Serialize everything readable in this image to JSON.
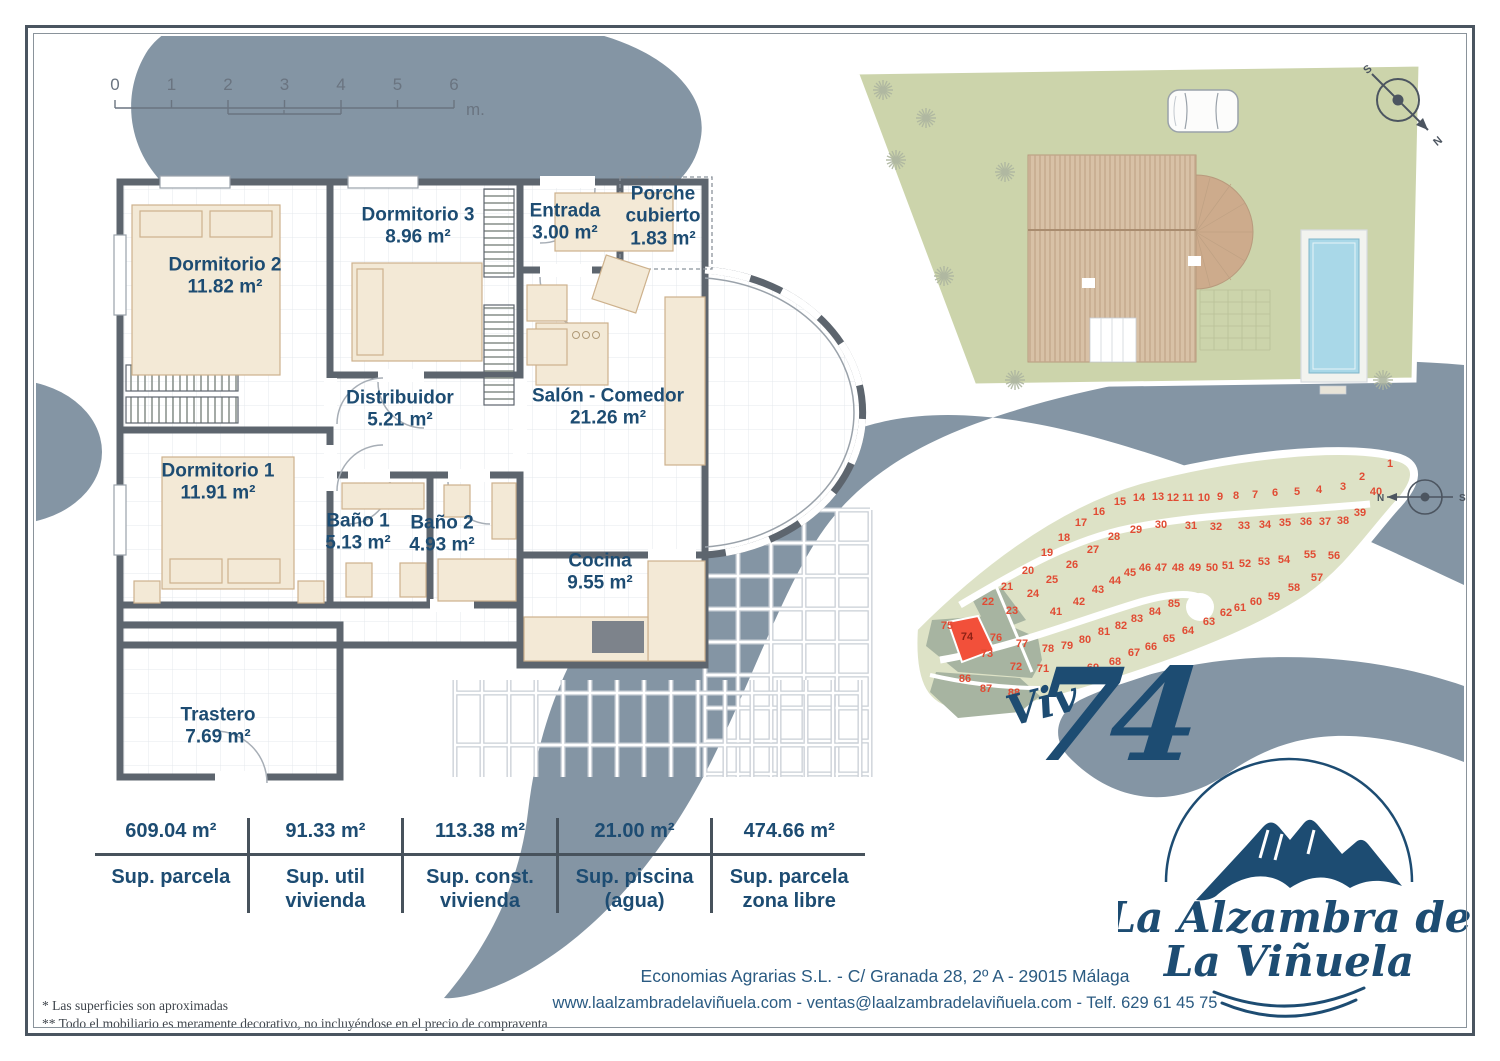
{
  "colors": {
    "navy": "#1d4c72",
    "wave_blue_gray": "#8495a4",
    "wall_gray": "#5d656e",
    "furniture_beige": "#f3e9d6",
    "plot_green": "#dde2c6",
    "plot_sold_olive": "#a7b4a1",
    "plot_highlight_red": "#f2503a",
    "plot_number_red": "#e14b33",
    "site_grass": "#ccd4ab",
    "roof_tan": "#d8c1a6",
    "pool_blue": "#a9d8e8",
    "frame_slate": "#4a5560"
  },
  "scale_bar": {
    "ticks": [
      "0",
      "1",
      "2",
      "3",
      "4",
      "5",
      "6"
    ],
    "unit": "m."
  },
  "floor_plan": {
    "rooms": [
      {
        "id": "dormitorio-2",
        "name": "Dormitorio 2",
        "area": "11.82 m²",
        "x": 125,
        "y": 112,
        "wrap": false
      },
      {
        "id": "dormitorio-3",
        "name": "Dormitorio 3",
        "area": "8.96 m²",
        "x": 318,
        "y": 62,
        "wrap": false
      },
      {
        "id": "entrada",
        "name": "Entrada",
        "area": "3.00 m²",
        "x": 465,
        "y": 58,
        "wrap": false
      },
      {
        "id": "porche-cubierto",
        "name": "Porche cubierto",
        "area": "1.83 m²",
        "x": 563,
        "y": 52,
        "wrap": true
      },
      {
        "id": "distribuidor",
        "name": "Distribuidor",
        "area": "5.21 m²",
        "x": 300,
        "y": 245,
        "wrap": false
      },
      {
        "id": "salon-comedor",
        "name": "Salón - Comedor",
        "area": "21.26 m²",
        "x": 508,
        "y": 243,
        "wrap": false
      },
      {
        "id": "dormitorio-1",
        "name": "Dormitorio 1",
        "area": "11.91 m²",
        "x": 118,
        "y": 318,
        "wrap": false
      },
      {
        "id": "bano-1",
        "name": "Baño 1",
        "area": "5.13 m²",
        "x": 258,
        "y": 368,
        "wrap": false
      },
      {
        "id": "bano-2",
        "name": "Baño 2",
        "area": "4.93 m²",
        "x": 342,
        "y": 370,
        "wrap": false
      },
      {
        "id": "cocina",
        "name": "Cocina",
        "area": "9.55 m²",
        "x": 500,
        "y": 408,
        "wrap": false
      },
      {
        "id": "trastero",
        "name": "Trastero",
        "area": "7.69 m²",
        "x": 118,
        "y": 562,
        "wrap": false
      }
    ]
  },
  "site_plan": {
    "compass": {
      "n": "N",
      "s": "S"
    }
  },
  "plot_map": {
    "highlighted_plot": 74,
    "sold_plots": [
      22,
      23,
      72,
      73,
      75,
      76,
      77,
      86,
      87,
      88
    ],
    "compass": {
      "n": "N",
      "s": "S"
    },
    "plots": [
      {
        "n": 1,
        "x": 490,
        "y": 47
      },
      {
        "n": 2,
        "x": 462,
        "y": 60
      },
      {
        "n": 3,
        "x": 443,
        "y": 70
      },
      {
        "n": 4,
        "x": 419,
        "y": 73
      },
      {
        "n": 5,
        "x": 397,
        "y": 75
      },
      {
        "n": 6,
        "x": 375,
        "y": 76
      },
      {
        "n": 7,
        "x": 355,
        "y": 78
      },
      {
        "n": 8,
        "x": 336,
        "y": 79
      },
      {
        "n": 9,
        "x": 320,
        "y": 80
      },
      {
        "n": 10,
        "x": 304,
        "y": 81
      },
      {
        "n": 11,
        "x": 288,
        "y": 81
      },
      {
        "n": 12,
        "x": 273,
        "y": 81
      },
      {
        "n": 13,
        "x": 258,
        "y": 80
      },
      {
        "n": 14,
        "x": 239,
        "y": 81
      },
      {
        "n": 15,
        "x": 220,
        "y": 85
      },
      {
        "n": 16,
        "x": 199,
        "y": 95
      },
      {
        "n": 17,
        "x": 181,
        "y": 106
      },
      {
        "n": 18,
        "x": 164,
        "y": 121
      },
      {
        "n": 19,
        "x": 147,
        "y": 136
      },
      {
        "n": 20,
        "x": 128,
        "y": 154
      },
      {
        "n": 21,
        "x": 107,
        "y": 170
      },
      {
        "n": 22,
        "x": 88,
        "y": 185
      },
      {
        "n": 23,
        "x": 112,
        "y": 194
      },
      {
        "n": 24,
        "x": 133,
        "y": 177
      },
      {
        "n": 25,
        "x": 152,
        "y": 163
      },
      {
        "n": 26,
        "x": 172,
        "y": 148
      },
      {
        "n": 27,
        "x": 193,
        "y": 133
      },
      {
        "n": 28,
        "x": 214,
        "y": 120
      },
      {
        "n": 29,
        "x": 236,
        "y": 113
      },
      {
        "n": 30,
        "x": 261,
        "y": 108
      },
      {
        "n": 31,
        "x": 291,
        "y": 109
      },
      {
        "n": 32,
        "x": 316,
        "y": 110
      },
      {
        "n": 33,
        "x": 344,
        "y": 109
      },
      {
        "n": 34,
        "x": 365,
        "y": 108
      },
      {
        "n": 35,
        "x": 385,
        "y": 106
      },
      {
        "n": 36,
        "x": 406,
        "y": 105
      },
      {
        "n": 37,
        "x": 425,
        "y": 105
      },
      {
        "n": 38,
        "x": 443,
        "y": 104
      },
      {
        "n": 39,
        "x": 460,
        "y": 96
      },
      {
        "n": 40,
        "x": 476,
        "y": 75
      },
      {
        "n": 41,
        "x": 156,
        "y": 195
      },
      {
        "n": 42,
        "x": 179,
        "y": 185
      },
      {
        "n": 43,
        "x": 198,
        "y": 173
      },
      {
        "n": 44,
        "x": 215,
        "y": 164
      },
      {
        "n": 45,
        "x": 230,
        "y": 156
      },
      {
        "n": 46,
        "x": 245,
        "y": 151
      },
      {
        "n": 47,
        "x": 261,
        "y": 151
      },
      {
        "n": 48,
        "x": 278,
        "y": 151
      },
      {
        "n": 49,
        "x": 295,
        "y": 151
      },
      {
        "n": 50,
        "x": 312,
        "y": 151
      },
      {
        "n": 51,
        "x": 328,
        "y": 149
      },
      {
        "n": 52,
        "x": 345,
        "y": 147
      },
      {
        "n": 53,
        "x": 364,
        "y": 145
      },
      {
        "n": 54,
        "x": 384,
        "y": 143
      },
      {
        "n": 55,
        "x": 410,
        "y": 138
      },
      {
        "n": 56,
        "x": 434,
        "y": 139
      },
      {
        "n": 57,
        "x": 417,
        "y": 161
      },
      {
        "n": 58,
        "x": 394,
        "y": 171
      },
      {
        "n": 59,
        "x": 374,
        "y": 180
      },
      {
        "n": 60,
        "x": 356,
        "y": 185
      },
      {
        "n": 61,
        "x": 340,
        "y": 191
      },
      {
        "n": 62,
        "x": 326,
        "y": 196
      },
      {
        "n": 63,
        "x": 309,
        "y": 205
      },
      {
        "n": 64,
        "x": 288,
        "y": 214
      },
      {
        "n": 65,
        "x": 269,
        "y": 222
      },
      {
        "n": 66,
        "x": 251,
        "y": 230
      },
      {
        "n": 67,
        "x": 234,
        "y": 236
      },
      {
        "n": 68,
        "x": 215,
        "y": 245
      },
      {
        "n": 69,
        "x": 193,
        "y": 251
      },
      {
        "n": 70,
        "x": 168,
        "y": 256
      },
      {
        "n": 71,
        "x": 143,
        "y": 252
      },
      {
        "n": 72,
        "x": 116,
        "y": 250
      },
      {
        "n": 73,
        "x": 87,
        "y": 237
      },
      {
        "n": 74,
        "x": 67,
        "y": 220
      },
      {
        "n": 75,
        "x": 47,
        "y": 209
      },
      {
        "n": 76,
        "x": 96,
        "y": 221
      },
      {
        "n": 77,
        "x": 122,
        "y": 227
      },
      {
        "n": 78,
        "x": 148,
        "y": 232
      },
      {
        "n": 79,
        "x": 167,
        "y": 229
      },
      {
        "n": 80,
        "x": 185,
        "y": 223
      },
      {
        "n": 81,
        "x": 204,
        "y": 215
      },
      {
        "n": 82,
        "x": 221,
        "y": 209
      },
      {
        "n": 83,
        "x": 237,
        "y": 202
      },
      {
        "n": 84,
        "x": 255,
        "y": 195
      },
      {
        "n": 85,
        "x": 274,
        "y": 187
      },
      {
        "n": 86,
        "x": 65,
        "y": 262
      },
      {
        "n": 87,
        "x": 86,
        "y": 272
      },
      {
        "n": 88,
        "x": 114,
        "y": 276
      }
    ]
  },
  "unit_title": {
    "prefix": "Viv",
    "number": "74"
  },
  "brand": {
    "line1": "La Alzambra de",
    "line2": "La Viñuela"
  },
  "summary_table": {
    "columns": [
      {
        "value": "609.04 m²",
        "label": "Sup. parcela"
      },
      {
        "value": "91.33 m²",
        "label": "Sup. util vivienda"
      },
      {
        "value": "113.38 m²",
        "label": "Sup. const. vivienda"
      },
      {
        "value": "21.00 m²",
        "label": "Sup. piscina (agua)"
      },
      {
        "value": "474.66 m²",
        "label": "Sup. parcela zona libre"
      }
    ]
  },
  "footer": {
    "line1": "Economias Agrarias S.L. - C/ Granada 28, 2º A - 29015 Málaga",
    "line2": "www.laalzambradelaviñuela.com - ventas@laalzambradelaviñuela.com - Telf. 629 61 45 75"
  },
  "footnotes": [
    "* Las superficies son aproximadas",
    "** Todo el mobiliario es meramente decorativo, no incluyéndose en el precio de compraventa"
  ]
}
